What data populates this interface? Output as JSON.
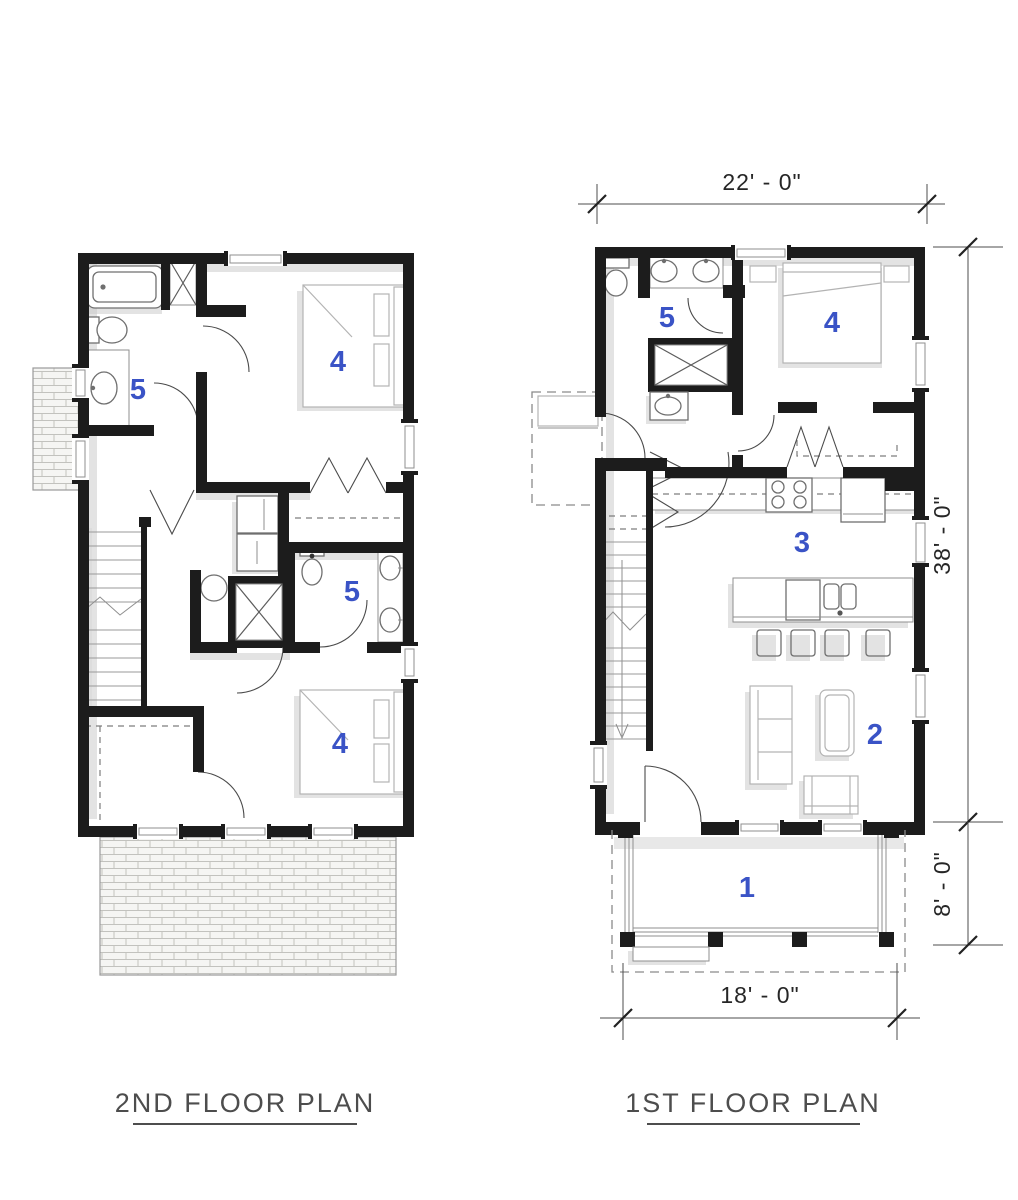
{
  "page": {
    "background": "#ffffff"
  },
  "colors": {
    "wall": "#1c1c1c",
    "room_label": "#3a53c6",
    "dimension_text": "#262626",
    "title_text": "#4d4d4d",
    "shadow": "#c7c7c7"
  },
  "plans": {
    "second": {
      "title": "2ND FLOOR PLAN",
      "room_labels": [
        "5",
        "4",
        "5",
        "4"
      ]
    },
    "first": {
      "title": "1ST FLOOR PLAN",
      "room_labels": [
        "5",
        "4",
        "3",
        "2",
        "1"
      ],
      "dimensions": {
        "top": "22' - 0\"",
        "right_upper": "38' - 0\"",
        "right_lower": "8' - 0\"",
        "bottom": "18' - 0\""
      }
    }
  }
}
